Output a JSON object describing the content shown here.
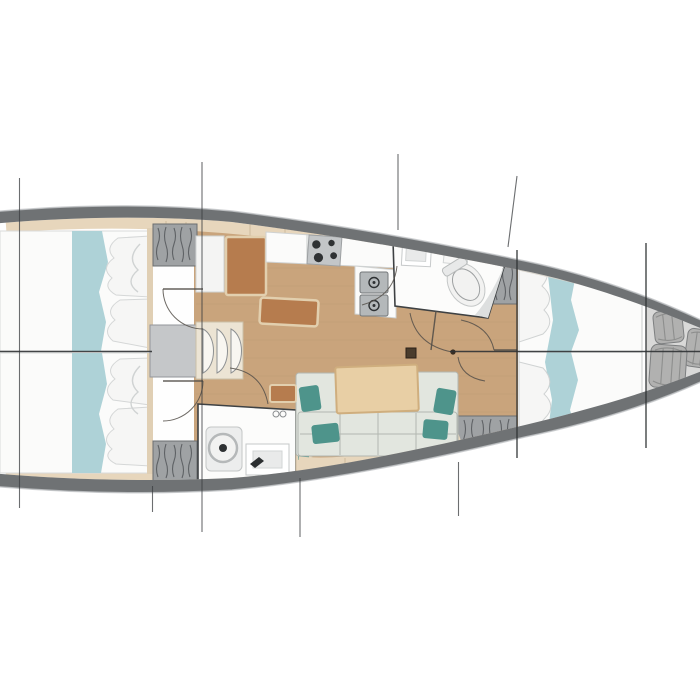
{
  "meta": {
    "image_type": "yacht-interior-floor-plan-top-view",
    "orientation": "bow-right-stern-left"
  },
  "counts": {
    "aft_cabins": 2,
    "heads": 2,
    "toilets": 2,
    "sink_basins": 2,
    "stove_burners": 4,
    "companionway_steps": 3,
    "bow_fenders": 3,
    "sofa_teal_pillows": 4,
    "berths": 3
  },
  "palette": {
    "page_bg": "#ffffff",
    "hull_band": "#6f7274",
    "hull_edge": "#c3c6c8",
    "interior_white": "#fefefe",
    "wood_floor": "#c9a47c",
    "trim_beige": "#e7d6bc",
    "headboard_beige": "#e0cfb4",
    "furniture_brown": "#b67c4e",
    "furniture_brown_border": "#e2cfae",
    "teal_fabric": "#aed2d7",
    "teal_pillow": "#4e948b",
    "sofa_cushion": "#e2e6df",
    "table_wood": "#e8cfa5",
    "table_wood_border": "#cfae7e",
    "locker_gray": "#9fa2a4",
    "room_white": "#fcfcfb",
    "appliance_gray": "#c3c6c8",
    "appliance_dark": "#2f3234",
    "sink_steel": "#b4b8ba",
    "engine_gray": "#c5c7c9",
    "steps_cream": "#ece4d4",
    "step_face": "#f8f6f1",
    "bow_locker": "#d9d9d8",
    "fender_gray": "#b1b1b0",
    "bed_white": "#fbfbfa",
    "pillow_white": "#f6f6f5",
    "toilet_white": "#f2f2f1",
    "mast_brown": "#4a3c2c"
  }
}
